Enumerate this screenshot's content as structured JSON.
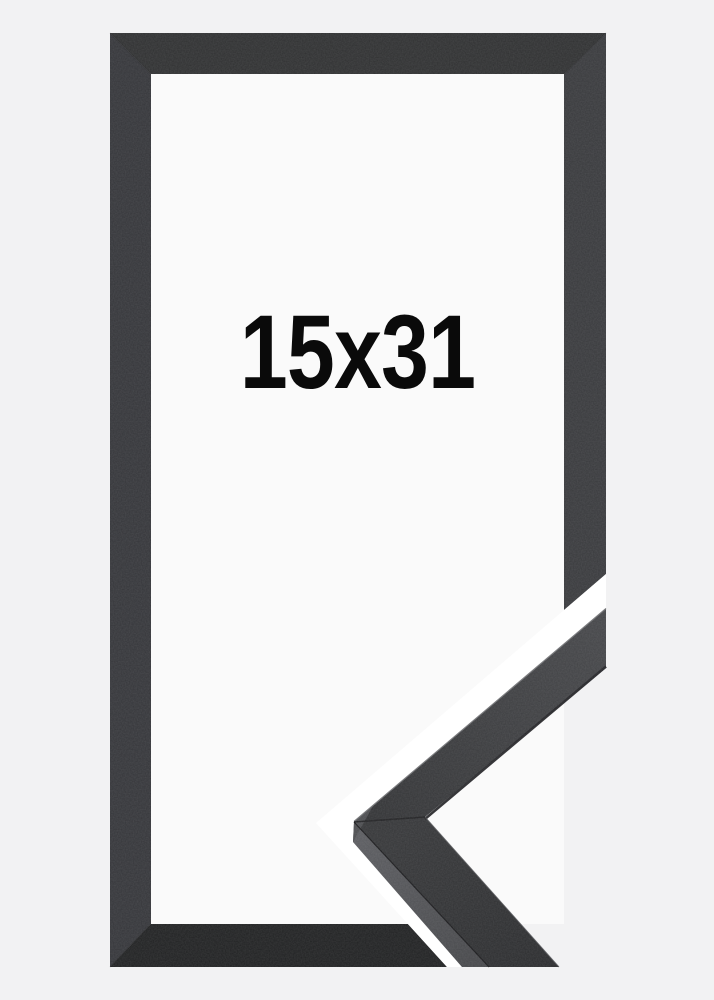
{
  "product": {
    "size_label": "15x31"
  },
  "colors": {
    "background": "#f2f2f3",
    "inner": "#fafafa",
    "frame_top": "#2f3031",
    "frame_left": "#343539",
    "frame_right": "#38393c",
    "frame_bottom": "#202122",
    "moulding_light": "#454649",
    "moulding_dark": "#313234",
    "moulding_lower_light": "#353638",
    "moulding_lower_dark": "#2a2b2d",
    "moulding_side_light": "#5a5b5f",
    "moulding_side_dark": "#46474a",
    "moulding_facet": "#4c4d50",
    "moulding_edge_highlight": "#6d6e71",
    "moulding_edge_shadow": "#232326",
    "cutout": "#ffffff",
    "text": "#0a0a0a"
  }
}
